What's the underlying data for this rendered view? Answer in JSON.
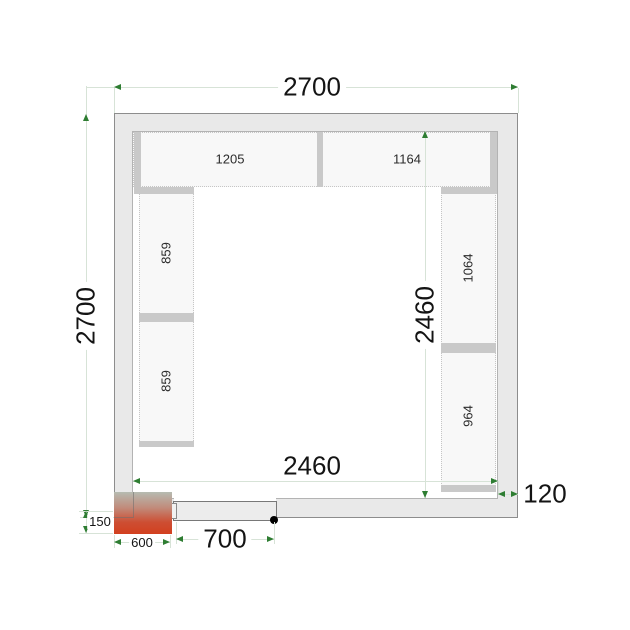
{
  "title": "Cold room floor plan drawing",
  "dimensions": {
    "outer_width": "2700",
    "outer_depth": "2700",
    "inner_width": "2460",
    "inner_depth": "2460",
    "wall_thickness": "120",
    "door_width": "700",
    "cooling_unit_width": "600",
    "cooling_unit_protrusion": "150"
  },
  "shelves": {
    "top": [
      "1205",
      "1164"
    ],
    "left": [
      "859",
      "859"
    ],
    "right": [
      "1064",
      "964"
    ]
  },
  "colors": {
    "dimension_arrow_green": "#2e7d32",
    "cooling_unit_red": "#d2401f",
    "wall_fill": "#e9e9e9",
    "shelf_fill": "#f8f8f8"
  }
}
